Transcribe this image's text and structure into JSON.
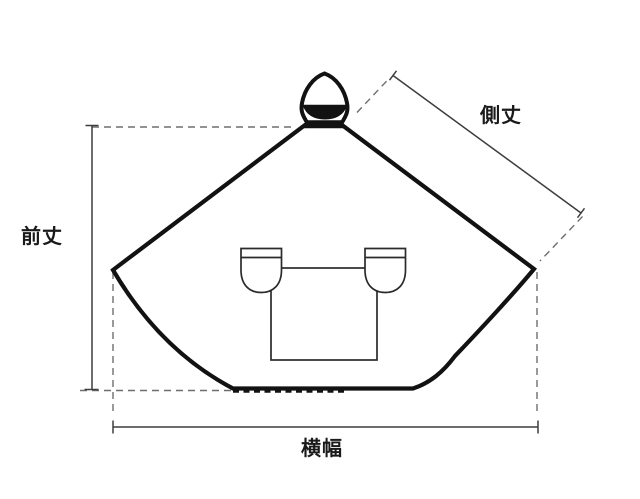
{
  "diagram": {
    "labels": {
      "front_length": "前丈",
      "side_length": "側丈",
      "width": "横幅"
    },
    "icons": {
      "garment": "poncho-with-hood-and-handlebar-covers"
    },
    "colors": {
      "background": "#ffffff",
      "garment_outline": "#121212",
      "measure_line": "#3d3d3d",
      "guide_dash": "#6e6e6e",
      "detail_line": "#2b2b2b",
      "label_text": "#1a1a1a"
    }
  }
}
